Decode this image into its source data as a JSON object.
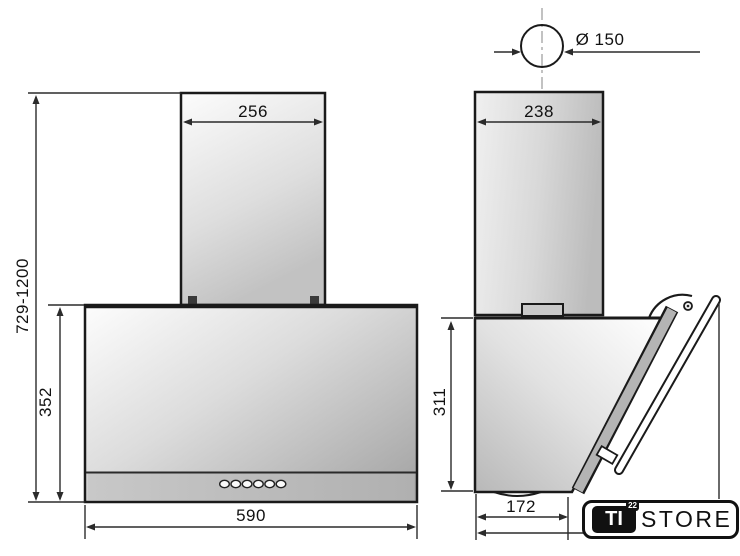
{
  "drawing": {
    "front_view": {
      "chimney_width": "256",
      "height_range": "729-1200",
      "body_height": "352",
      "body_width": "590"
    },
    "side_view": {
      "chimney_depth": "238",
      "duct_diameter": "Ø 150",
      "body_height": "311",
      "body_depth": "172"
    }
  },
  "logo": {
    "prefix": "TI",
    "superscript": "22",
    "name": "STORE"
  },
  "colors": {
    "outline": "#1a1a1a",
    "dimension_line": "#2b2b2b",
    "text": "#111111"
  }
}
